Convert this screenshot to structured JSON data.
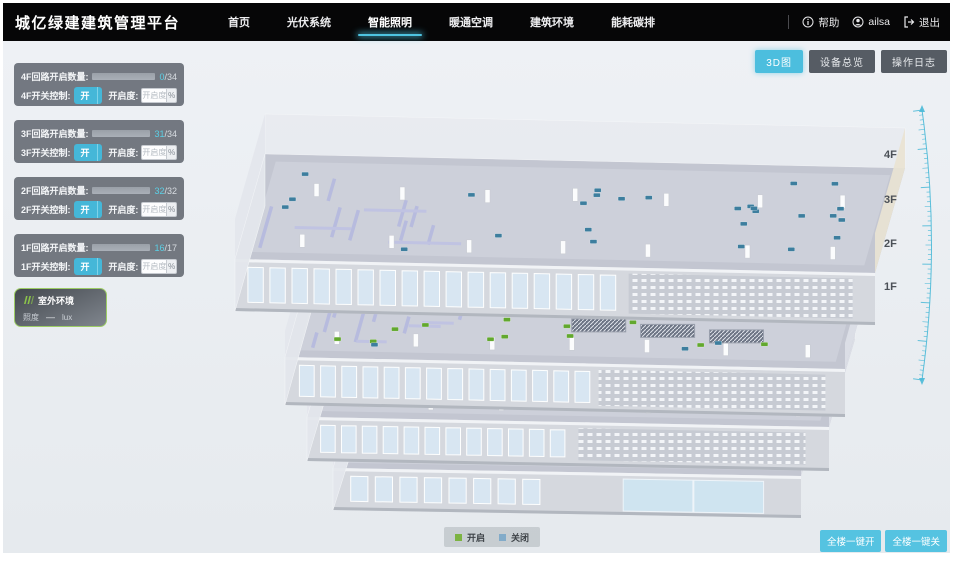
{
  "header": {
    "title": "城亿绿建建筑管理平台",
    "nav": [
      {
        "label": "首页"
      },
      {
        "label": "光伏系统"
      },
      {
        "label": "智能照明"
      },
      {
        "label": "暖通空调"
      },
      {
        "label": "建筑环境"
      },
      {
        "label": "能耗碳排"
      }
    ],
    "active_nav": "智能照明",
    "help_label": "帮助",
    "user_name": "ailsa",
    "logout_label": "退出"
  },
  "toolbar": {
    "view_3d_label": "3D图",
    "device_overview_label": "设备总览",
    "operation_log_label": "操作日志"
  },
  "floor_panels": [
    {
      "floor": "4F",
      "count_label": "4F回路开启数量:",
      "count_on": "0",
      "count_sep": "/",
      "count_total": "34",
      "progress": 0,
      "switch_label": "4F开关控制:",
      "on_label": "开",
      "off_label": "关",
      "dim_label": "开启度:",
      "dim_placeholder": "开启度",
      "percent_label": "%"
    },
    {
      "floor": "3F",
      "count_label": "3F回路开启数量:",
      "count_on": "31",
      "count_sep": "/",
      "count_total": "34",
      "progress": 91,
      "switch_label": "3F开关控制:",
      "on_label": "开",
      "off_label": "关",
      "dim_label": "开启度:",
      "dim_placeholder": "开启度",
      "percent_label": "%"
    },
    {
      "floor": "2F",
      "count_label": "2F回路开启数量:",
      "count_on": "32",
      "count_sep": "/",
      "count_total": "32",
      "progress": 100,
      "switch_label": "2F开关控制:",
      "on_label": "开",
      "off_label": "关",
      "dim_label": "开启度:",
      "dim_placeholder": "开启度",
      "percent_label": "%"
    },
    {
      "floor": "1F",
      "count_label": "1F回路开启数量:",
      "count_on": "16",
      "count_sep": "/",
      "count_total": "17",
      "progress": 94,
      "switch_label": "1F开关控制:",
      "on_label": "开",
      "off_label": "关",
      "dim_label": "开启度:",
      "dim_placeholder": "开启度",
      "percent_label": "%"
    }
  ],
  "outdoor_panel": {
    "title": "室外环境",
    "metric_label": "照度",
    "metric_value": "—",
    "metric_unit": "lux"
  },
  "floor_axis_labels": [
    "4F",
    "3F",
    "2F",
    "1F"
  ],
  "legend": {
    "on_label": "开启",
    "off_label": "关闭",
    "on_color": "#7cb342",
    "off_color": "#82abc9"
  },
  "bottom_actions": {
    "all_on_label": "全楼一键开",
    "all_off_label": "全楼一键关"
  },
  "building": {
    "floors": [
      {
        "name": "4F",
        "dots_on": 0,
        "dots_off": 27
      },
      {
        "name": "3F",
        "dots_on": 30,
        "dots_off": 3
      },
      {
        "name": "2F",
        "dots_on": 17,
        "dots_off": 2
      },
      {
        "name": "1F",
        "dots_on": 8,
        "dots_off": 0
      }
    ],
    "colors": {
      "dot_on": "#62a82e",
      "dot_off": "#3d7e9e"
    }
  }
}
